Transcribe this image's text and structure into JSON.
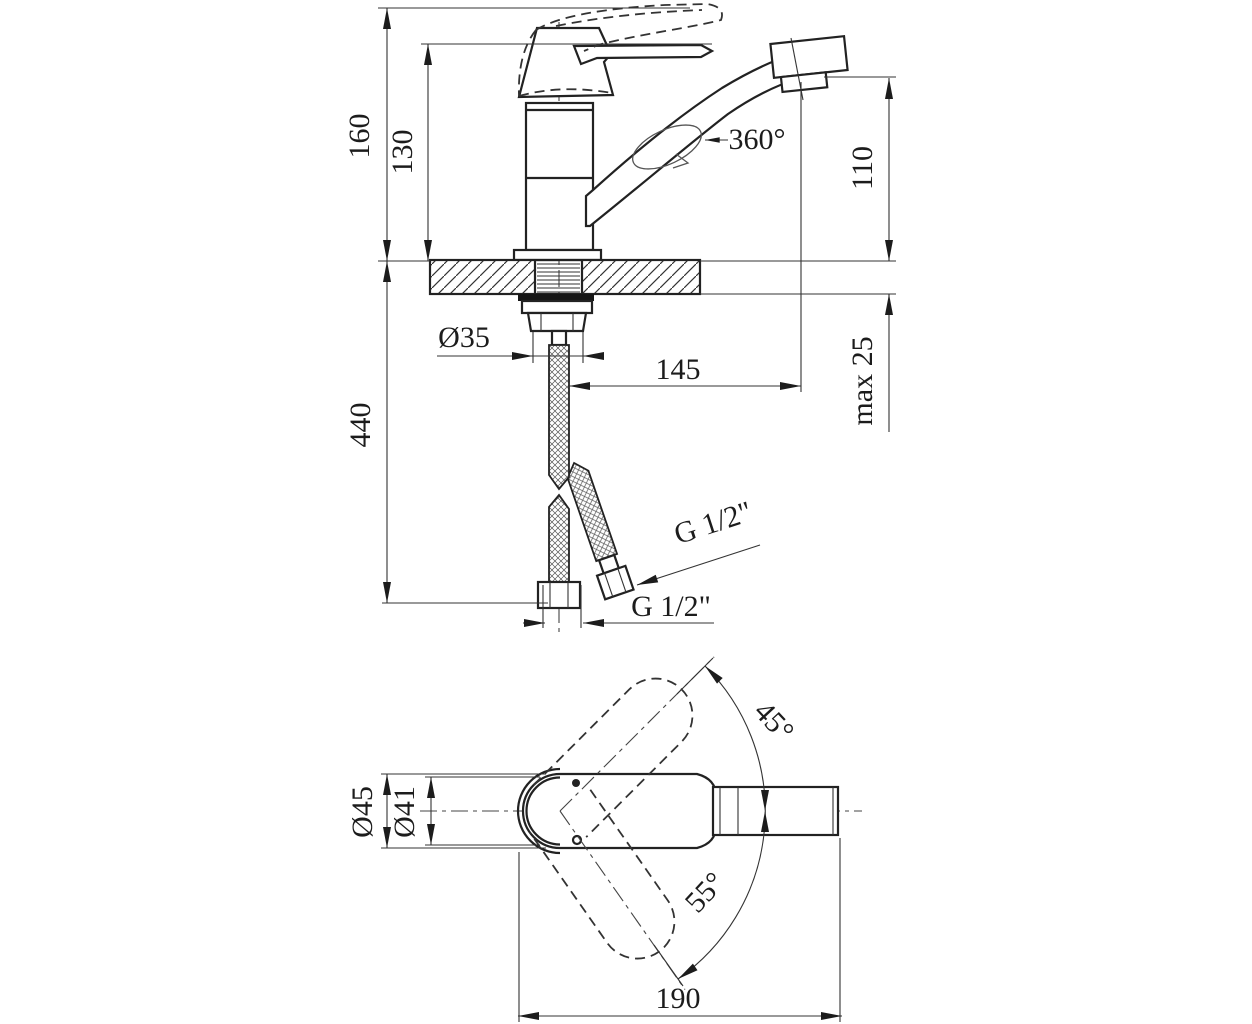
{
  "drawing": {
    "product": "single-lever faucet dimensional drawing",
    "units": "mm",
    "side_view": {
      "total_height": "160",
      "body_height": "130",
      "spout_height": "110",
      "spout_swivel": "360°",
      "shank_diameter": "Ø35",
      "spout_reach": "145",
      "max_counter_thickness": "max 25",
      "hose_length": "440",
      "side_hose_thread": "G 1/2\"",
      "bottom_hose_thread": "G 1/2\""
    },
    "plan_view": {
      "body_diameter_outer": "Ø45",
      "body_diameter_inner": "Ø41",
      "handle_swing_up": "45°",
      "handle_swing_down": "55°",
      "overall_length": "190"
    }
  }
}
